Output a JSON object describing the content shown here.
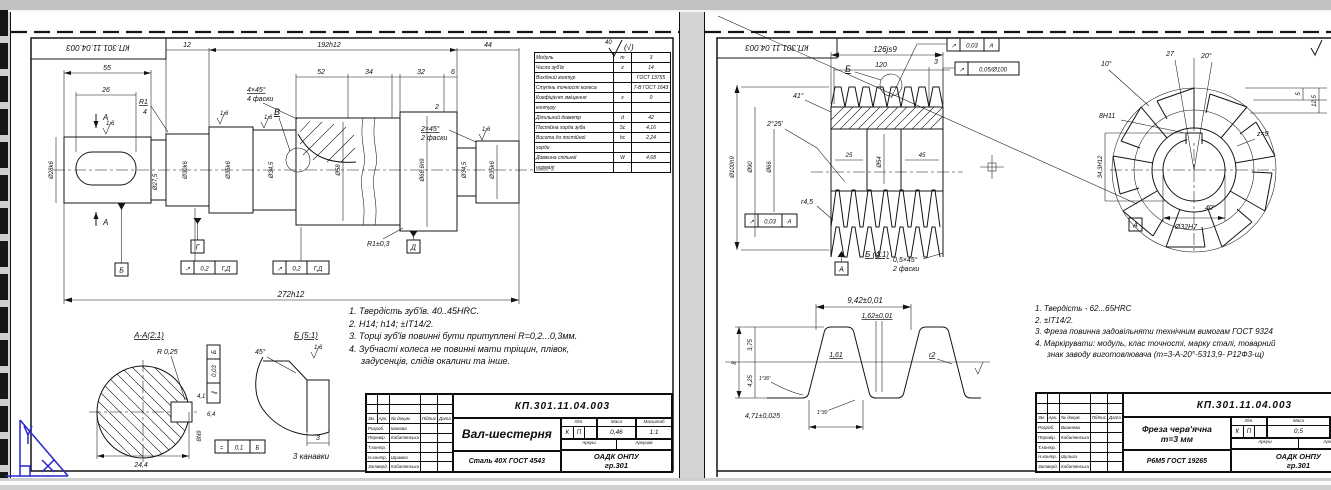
{
  "left_sheet": {
    "corner_doc_number": "КП.301.11.04.003",
    "roughness_mark": "40",
    "roughness_alt": "(√)",
    "notes": [
      "1. Твердість зуб'їв. 40..45HRC.",
      "2. Н14; h14; ±IT14/2.",
      "3. Торці зуб'їв повинні бути притуплені R=0,2...0,3мм.",
      "4. Зубчасті колеса не повинні мати тріщин, плівок,",
      "задусенців, слідів окалини та інше."
    ],
    "param_table": {
      "rows": [
        {
          "label": "Модуль",
          "sym": "m",
          "val": "3"
        },
        {
          "label": "Число зуб'їв",
          "sym": "z",
          "val": "14"
        },
        {
          "label": "Вихідний контур",
          "sym": "",
          "val": "ГОСТ 13755"
        },
        {
          "label": "Ступінь точності колеса",
          "sym": "",
          "val": "7-В ГОСТ 1643"
        },
        {
          "label": "Коефіцієнт зміщення",
          "sym": "x",
          "val": "0"
        },
        {
          "label": "контуру",
          "sym": "",
          "val": ""
        },
        {
          "label": "Ділильний діаметр",
          "sym": "d",
          "val": "42"
        },
        {
          "label": "Постійна хорда зуба",
          "sym": "Sc",
          "val": "4,16"
        },
        {
          "label": "Висота до постійної",
          "sym": "hc",
          "val": "2,24"
        },
        {
          "label": "хорди",
          "sym": "",
          "val": ""
        },
        {
          "label": "Довжина спільної",
          "sym": "W",
          "val": "4,68"
        },
        {
          "label": "нормалі",
          "sym": "",
          "val": ""
        }
      ]
    },
    "dims": {
      "a": "12",
      "b": "192h12",
      "c": "44",
      "d": "55",
      "e": "26",
      "f": "52",
      "g": "34",
      "h": "32",
      "i": "6",
      "j": "2",
      "k": "R1",
      "k2": "4",
      "callout": "В",
      "ch1": "4×45°",
      "ch1b": "4 фаски",
      "ch2": "2×45°",
      "ch2b": "2 фаски",
      "dia1": "Ø28k6",
      "dia2": "Ø27,5",
      "dia3": "Ø30k6",
      "dia4": "Ø35k6",
      "dia5": "Ø34,5",
      "dia6": "Ø58",
      "dia7": "Ø66,6h9",
      "dia8": "Ø34,5",
      "dia9": "Ø35k6",
      "total": "272h12",
      "fillet": "R1±0,3",
      "ra": "1,6",
      "section": "А"
    },
    "frames": {
      "f1s": "↗",
      "f1t": "0,2",
      "f1d": "Г,Д",
      "f2s": "↗",
      "f2t": "0,2",
      "f2d": "Г,Д",
      "fvs": "∥",
      "fvt": "0,03",
      "fvd": "Б",
      "fss": "=",
      "fst": "0,1",
      "fsd": "Б"
    },
    "datums": {
      "d1": "Б",
      "d2": "Г",
      "d3": "Д"
    },
    "section_aa": {
      "title": "А-А(2:1)",
      "r": "R 0,25",
      "w1": "4,1",
      "w2": "6,4",
      "kw": "8N9",
      "width": "24,4"
    },
    "view_b": {
      "title": "Б (5:1)",
      "angle": "45°",
      "w": "3",
      "caption": "3 канавки",
      "ra": "1,6"
    },
    "title_block": {
      "doc_number": "КП.301.11.04.003",
      "name": "Вал-шестерня",
      "material": "Сталь 40Х ГОСТ 4543",
      "liter_label": "Літ.",
      "mass_label": "Маса",
      "scale_label": "Масштаб",
      "liter1": "К",
      "liter2": "П",
      "mass": "0,46",
      "scale": "1:1",
      "sheet_label": "Аркуш",
      "sheets_label": "Аркушів",
      "org": "ОАДК ОНПУ",
      "org2": "гр.301",
      "sig_header": [
        "Зм.",
        "Арк.",
        "№ докум.",
        "Підпис",
        "Дата"
      ],
      "rows": [
        [
          "Розроб.",
          "Іванова"
        ],
        [
          "Перевір.",
          "Кабатянська"
        ],
        [
          "Т.контр.",
          ""
        ],
        [
          "Н.контр.",
          "Шрамко"
        ],
        [
          "Затверд.",
          "Кабатянська"
        ]
      ]
    }
  },
  "right_sheet": {
    "corner_doc_number": "КП.301.11.04.003",
    "notes": [
      "1. Твердість  -  62...65HRC",
      "2. ±IT14/2.",
      "3. Фреза повинна задовільняти технічним вимогам ГОСТ 9324",
      "4. Маркірувати: модуль, клас точності, марку сталі, товарний",
      "знак заводу виготовлювача (m=3-А-20°-5313,9- Р12Ф3-щ)"
    ],
    "dims": {
      "w126": "126js9",
      "w120": "120",
      "w3": "3",
      "a41": "41°",
      "a225": "2°25'",
      "c25": "25",
      "c45": "45",
      "d54": "Ø54",
      "d100": "Ø100h9",
      "d90": "Ø90",
      "d66": "Ø66",
      "r45": "r4,5",
      "ch": "0,5×45°",
      "chb": "2 фаски",
      "callout": "Б"
    },
    "frames": {
      "f1s": "↗",
      "f1t": "0,03",
      "f1d": "А",
      "f2s": "↗",
      "f2t": "0,05/Ø100",
      "f3s": "↗",
      "f3t": "0,03",
      "f3d": "А"
    },
    "datum": "А",
    "end_view": {
      "a10": "10°",
      "w27": "27",
      "a20": "20°",
      "h5": "5",
      "h125": "12,5",
      "kw": "8Н11",
      "kd": "34,3Н12",
      "bore": "Ø32Н7",
      "a40": "40°",
      "flutes": "z=9"
    },
    "profile": {
      "title": "Б (4:1)",
      "pitch": "9,42±0,01",
      "groove": "1,62±0,01",
      "top": "1,61",
      "h1": "3,75",
      "h2": "4,25",
      "h": "8",
      "r": "r2",
      "base": "4,71±0,025",
      "ang1": "1°30'",
      "ang2": "1°30'"
    },
    "title_block": {
      "doc_number": "КП.301.11.04.003",
      "name1": "Фреза черв'ячна",
      "name2": "m=3 мм",
      "material": "Р6М5 ГОСТ 19265",
      "liter_label": "Літ.",
      "mass_label": "Маса",
      "scale_label": "Масштаб",
      "liter1": "К",
      "liter2": "П",
      "mass": "0,5",
      "scale": "",
      "sheet_label": "Аркуш",
      "sheets_label": "Аркушів",
      "org": "ОАДК ОНПУ",
      "org2": "гр.301",
      "sig_header": [
        "Зм.",
        "Арк.",
        "№ докум.",
        "Підпис",
        "Дата"
      ],
      "rows": [
        [
          "Розроб.",
          "Вишнева"
        ],
        [
          "Перевір.",
          "Кабатянська"
        ],
        [
          "Т.контр.",
          ""
        ],
        [
          "Н.контр.",
          "Шульга"
        ],
        [
          "Затверд.",
          "Кабатянська"
        ]
      ]
    }
  }
}
